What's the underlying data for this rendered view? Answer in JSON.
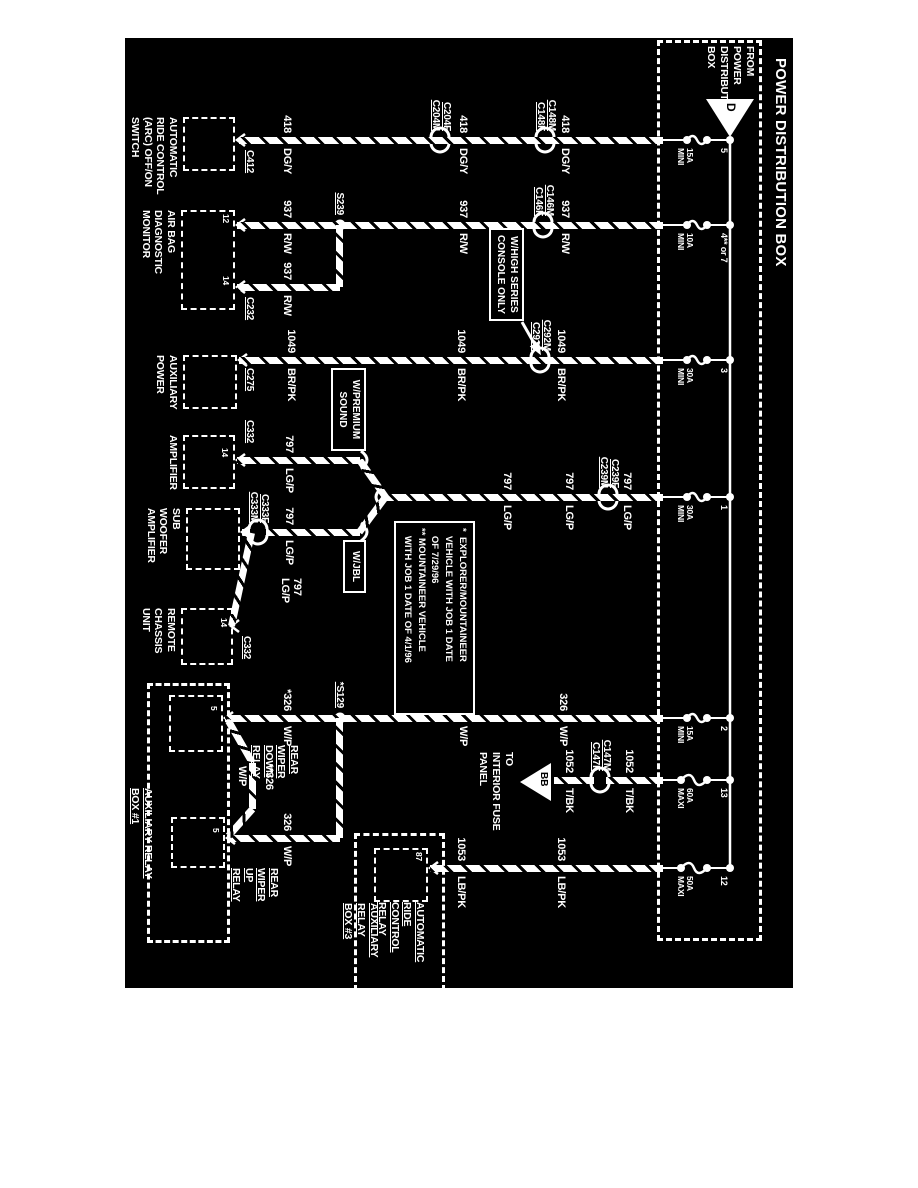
{
  "colors": {
    "paper": "#ffffff",
    "ink": "#000000",
    "line": "#ffffff"
  },
  "power_box": {
    "title": "POWER DISTRIBUTION BOX",
    "from_label": [
      "FROM",
      "POWER",
      "DISTRIBUTION",
      "BOX"
    ],
    "triangle": "D",
    "box": [
      40,
      156,
      895,
      99
    ],
    "bus_y": 188,
    "fuses": [
      {
        "number": "5",
        "rating": [
          "15A",
          "MINI"
        ],
        "x": 140,
        "maxi": false
      },
      {
        "number": "4** or 7",
        "rating": [
          "10A",
          "MINI"
        ],
        "x": 225,
        "maxi": false
      },
      {
        "number": "3",
        "rating": [
          "30A",
          "MINI"
        ],
        "x": 360,
        "maxi": false
      },
      {
        "number": "1",
        "rating": [
          "30A",
          "MINI"
        ],
        "x": 497,
        "maxi": false
      },
      {
        "number": "2",
        "rating": [
          "15A",
          "MINI"
        ],
        "x": 718,
        "maxi": false
      },
      {
        "number": "13",
        "rating": [
          "60A",
          "MAXI"
        ],
        "x": 780,
        "maxi": true
      },
      {
        "number": "12",
        "rating": [
          "50A",
          "MAXI"
        ],
        "x": 868,
        "maxi": true
      }
    ]
  },
  "wires": [
    {
      "name": "418",
      "segs": [
        [
          "v",
          140,
          255,
          679
        ]
      ]
    },
    {
      "name": "937",
      "segs": [
        [
          "v",
          225,
          255,
          681
        ],
        [
          "h",
          578,
          225,
          287
        ],
        [
          "v",
          287,
          578,
          681
        ]
      ]
    },
    {
      "name": "1049",
      "segs": [
        [
          "v",
          360,
          255,
          679
        ]
      ]
    },
    {
      "name": "797",
      "segs": [
        [
          "v",
          497,
          255,
          534
        ],
        [
          "d",
          497,
          532,
          460,
          558
        ],
        [
          "d",
          497,
          532,
          532,
          558
        ],
        [
          "v",
          460,
          558,
          681
        ],
        [
          "v",
          532,
          558,
          652
        ],
        [
          "v",
          532,
          668,
          676
        ],
        [
          "d",
          533,
          666,
          626,
          686
        ]
      ]
    },
    {
      "name": "326",
      "segs": [
        [
          "v",
          718,
          255,
          693
        ],
        [
          "h",
          578,
          718,
          838
        ],
        [
          "v",
          838,
          578,
          691
        ],
        [
          "d",
          721,
          689,
          763,
          665
        ],
        [
          "h",
          665,
          763,
          809
        ],
        [
          "d",
          809,
          665,
          836,
          689
        ]
      ]
    },
    {
      "name": "1052",
      "segs": [
        [
          "v",
          780,
          255,
          312
        ],
        [
          "v",
          780,
          324,
          364
        ]
      ]
    },
    {
      "name": "1053",
      "segs": [
        [
          "v",
          868,
          255,
          488
        ]
      ]
    }
  ],
  "wire_labels": [
    {
      "num": "418",
      "color": "DG/Y",
      "x": 140,
      "y": 348
    },
    {
      "num": "418",
      "color": "DG/Y",
      "x": 140,
      "y": 450
    },
    {
      "num": "418",
      "color": "DG/Y",
      "x": 140,
      "y": 626
    },
    {
      "num": "937",
      "color": "R/W",
      "x": 225,
      "y": 348
    },
    {
      "num": "937",
      "color": "R/W",
      "x": 225,
      "y": 450
    },
    {
      "num": "937",
      "color": "R/W",
      "x": 225,
      "y": 626
    },
    {
      "num": "937",
      "color": "R/W",
      "x": 287,
      "y": 626
    },
    {
      "num": "1049",
      "color": "BR/PK",
      "x": 360,
      "y": 352
    },
    {
      "num": "1049",
      "color": "BR/PK",
      "x": 360,
      "y": 452
    },
    {
      "num": "1049",
      "color": "BR/PK",
      "x": 360,
      "y": 622
    },
    {
      "num": "797",
      "color": "LG/P",
      "x": 497,
      "y": 286
    },
    {
      "num": "797",
      "color": "LG/P",
      "x": 497,
      "y": 344
    },
    {
      "num": "797",
      "color": "LG/P",
      "x": 497,
      "y": 406
    },
    {
      "num": "797",
      "color": "LG/P",
      "x": 460,
      "y": 624
    },
    {
      "num": "797",
      "color": "LG/P",
      "x": 532,
      "y": 624
    },
    {
      "num": "326",
      "color": "W/P",
      "x": 718,
      "y": 350
    },
    {
      "num": "326",
      "color": "W/P",
      "x": 718,
      "y": 450
    },
    {
      "num": "*326",
      "color": "W/P",
      "x": 718,
      "y": 626
    },
    {
      "num": "326",
      "color": "W/P",
      "x": 838,
      "y": 626
    },
    {
      "num": "1052",
      "color": "T/BK",
      "x": 780,
      "y": 284
    },
    {
      "num": "1052",
      "color": "T/BK",
      "x": 780,
      "y": 344
    },
    {
      "num": "1053",
      "color": "LB/PK",
      "x": 868,
      "y": 352
    },
    {
      "num": "1053",
      "color": "LB/PK",
      "x": 868,
      "y": 452
    }
  ],
  "stacked_labels": [
    {
      "lines": [
        "797",
        "LG/P"
      ],
      "x": 578,
      "y": 616
    },
    {
      "lines": [
        "**326"
      ],
      "x": 764,
      "y": 644
    },
    {
      "lines": [
        "W/P"
      ],
      "x": 766,
      "y": 671
    }
  ],
  "inline_connectors": [
    {
      "lines": [
        "C204F",
        "C204M"
      ],
      "x": 140,
      "y": 478
    },
    {
      "lines": [
        "C148M",
        "C148F"
      ],
      "x": 140,
      "y": 373
    },
    {
      "lines": [
        "C146M",
        "C146F"
      ],
      "x": 225,
      "y": 375
    },
    {
      "lines": [
        "C292M",
        "C292F"
      ],
      "x": 360,
      "y": 378
    },
    {
      "lines": [
        "C239F",
        "C239M"
      ],
      "x": 497,
      "y": 310
    },
    {
      "lines": [
        "C147M",
        "C147F"
      ],
      "x": 780,
      "y": 318
    },
    {
      "lines": [
        "C333F",
        "C333M"
      ],
      "x": 532,
      "y": 660
    }
  ],
  "end_connectors": [
    {
      "label": "C412",
      "x": 150,
      "y": 663
    },
    {
      "label": "C232",
      "x": 297,
      "y": 663
    },
    {
      "label": "C275",
      "x": 368,
      "y": 663
    },
    {
      "label": "C332",
      "x": 420,
      "y": 663
    },
    {
      "label": "C332",
      "x": 636,
      "y": 666
    }
  ],
  "splices": [
    {
      "label": "S239",
      "x": 225,
      "y": 578
    },
    {
      "label": "*S129",
      "x": 718,
      "y": 578
    }
  ],
  "components": [
    {
      "name_lines": [
        "AUTOMATIC",
        "RIDE CONTROL",
        "(ARC) OFF/ON",
        "SWITCH"
      ],
      "box": [
        117,
        683,
        50,
        48
      ],
      "pins": [],
      "underline": false
    },
    {
      "name_lines": [
        "AIR BAG",
        "DIAGNOSTIC",
        "MONITOR"
      ],
      "box": [
        210,
        683,
        96,
        50
      ],
      "pins": [
        {
          "t": "12",
          "x": 214,
          "y": 688
        },
        {
          "t": "14",
          "x": 276,
          "y": 688
        }
      ],
      "underline": false
    },
    {
      "name_lines": [
        "AUXILIARY",
        "POWER"
      ],
      "box": [
        355,
        681,
        50,
        50
      ],
      "pins": [],
      "underline": false
    },
    {
      "name_lines": [
        "AMPLIFIER"
      ],
      "box": [
        435,
        683,
        50,
        48
      ],
      "pins": [
        {
          "t": "14",
          "x": 448,
          "y": 689
        }
      ],
      "underline": false
    },
    {
      "name_lines": [
        "SUB",
        "WOOFER",
        "AMPLIFIER"
      ],
      "box": [
        508,
        678,
        58,
        50
      ],
      "pins": [],
      "underline": false
    },
    {
      "name_lines": [
        "REMOTE",
        "CHASSIS",
        "UNIT"
      ],
      "box": [
        608,
        685,
        53,
        48
      ],
      "pins": [
        {
          "t": "14",
          "x": 618,
          "y": 690
        }
      ],
      "underline": false
    },
    {
      "name_lines": [
        "REAR",
        "WIPER",
        "DOWN",
        "RELAY"
      ],
      "box": [
        695,
        695,
        53,
        50
      ],
      "pins": [
        {
          "t": "5",
          "x": 706,
          "y": 700
        }
      ],
      "underline": true,
      "label_pos": [
        745,
        618
      ]
    },
    {
      "name_lines": [
        "REAR",
        "WIPER",
        "UP",
        "RELAY"
      ],
      "box": [
        817,
        693,
        47,
        50
      ],
      "pins": [
        {
          "t": "5",
          "x": 828,
          "y": 698
        }
      ],
      "underline": true,
      "label_pos": [
        868,
        638
      ]
    },
    {
      "name_lines": [
        "AUTOMATIC",
        "RIDE",
        "CONTROL",
        "RELAY"
      ],
      "box": [
        848,
        490,
        50,
        50
      ],
      "pins": [
        {
          "t": "87",
          "x": 852,
          "y": 495
        }
      ],
      "underline": true,
      "label_pos": [
        902,
        492
      ]
    }
  ],
  "group_boxes": [
    {
      "label_lines": [
        "AUXILIARY RELAY",
        "BOX #1"
      ],
      "box": [
        683,
        688,
        254,
        77
      ],
      "label_pos": [
        788,
        764
      ]
    },
    {
      "label_lines": [
        "AUXILIARY",
        "RELAY",
        "BOX #3"
      ],
      "box": [
        833,
        473,
        152,
        85
      ],
      "label_pos": [
        903,
        538
      ]
    }
  ],
  "callouts": [
    {
      "lines": [
        "W/HIGH SERIES",
        "CONSOLE ONLY"
      ],
      "box": [
        228,
        394,
        94,
        34
      ],
      "arrow": [
        [
          322,
          396
        ],
        [
          350,
          380
        ]
      ]
    },
    {
      "lines": [
        "W/PREMIUM",
        "SOUND"
      ],
      "box": [
        368,
        552,
        84,
        34
      ]
    },
    {
      "lines": [
        "W/JBL"
      ],
      "box": [
        540,
        552,
        54,
        20
      ]
    }
  ],
  "note_box": {
    "box": [
      521,
      443,
      192,
      80
    ],
    "lines": [
      "*  EXPLORER/MOUNTAINEER",
      "   VEHICLE WITH JOB 1 DATE",
      "   OF 7/29/96",
      "** MOUNTAINEER VEHICLE",
      "   WITH JOB 1 DATE OF 4/1/96"
    ]
  },
  "to_panel": {
    "triangle": "BB",
    "lines": [
      "TO",
      "INTERIOR FUSE",
      "PANEL"
    ],
    "pos": [
      752,
      403
    ],
    "tri": [
      763,
      367,
      801,
      367,
      782,
      398
    ]
  }
}
